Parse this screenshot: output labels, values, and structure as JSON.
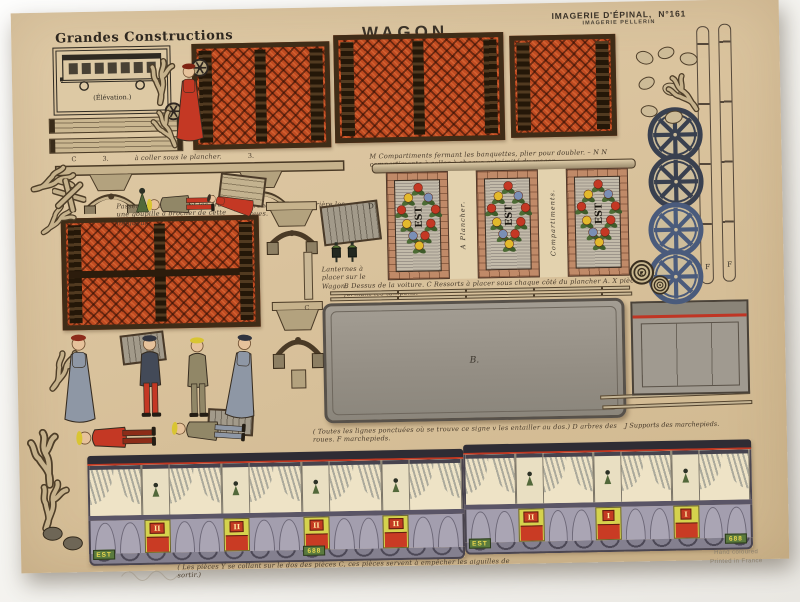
{
  "photo": {
    "backdrop": "#f4f3f0"
  },
  "header": {
    "series": "Grandes Constructions",
    "title": "WAGON",
    "imagerie": "IMAGERIE D'ÉPINAL,",
    "number": "N°161",
    "pellerin": "IMAGERIE PELLERIN"
  },
  "elevation": {
    "caption": "(Élévation.)"
  },
  "captions": {
    "row1": {
      "letter": "C",
      "num_left": "3.",
      "text": "à coller sous le plancher.",
      "num_right": "3."
    },
    "compartiments": "M Compartiments fermant les banquettes, plier pour doubler. – N N compartiments à coller à chaque extrémité du wagon.",
    "passer": "Passer par les roues et les arbres une goupille à brocher de cette longueur.",
    "ronds": "V ronds à coller derrière les roues.",
    "dessus": "B Dessus de la voiture. C Ressorts à placer sous chaque côté du plancher A. X pièces formant les tampons.",
    "lanternes": "Lanternes à placer sur le Wagon.",
    "ponctuees": "( Toutes les lignes ponctuées où se trouve ce signe v les entailler au dos.) D arbres des roues. F marchepieds.",
    "supports": "J Supports des marchepieds.",
    "aiguilles": "( Les pièces Y se collant sur le dos des pièces C, ces pièces servent à empêcher les aiguilles de sortir.)"
  },
  "labels": {
    "b": "B.",
    "c": "C",
    "d": "D",
    "f": "F",
    "k": "K"
  },
  "door_strip": {
    "panels": [
      "EST",
      "EST",
      "EST"
    ],
    "dividers": [
      "A Plancher.",
      "Compartiments."
    ]
  },
  "wagon_sides": [
    {
      "name": "side-1",
      "est": "EST",
      "number": "688",
      "class_plates": [
        "II",
        "II",
        "II",
        "II"
      ]
    },
    {
      "name": "side-2",
      "est": "EST",
      "number": "688",
      "class_plates": [
        "II",
        "I",
        "I"
      ]
    }
  ],
  "wheels": {
    "count": 4
  },
  "footer": {
    "line1": "Hand coloured",
    "line2": "Printed in France"
  },
  "colors": {
    "paper": "#d9c29c",
    "ink": "#3b3127",
    "lattice": "#bf4a20",
    "frame": "#3f2c17",
    "roof_gray": "#99938a",
    "body_gray": "#a39eae",
    "curtain_blue": "#5f7d94",
    "door_yellow": "#d5d24d",
    "signal_red": "#c43824",
    "plate_green": "#5a7a3e",
    "plate_text": "#ecd94e",
    "wheel": "#39404f",
    "wheel_alt": "#4a5b7c",
    "wood": "#c6b28c",
    "khaki": "#918767",
    "coat_slate": "#434a58",
    "dress_gray": "#8e97a5",
    "hat_yellow": "#d9c532"
  }
}
